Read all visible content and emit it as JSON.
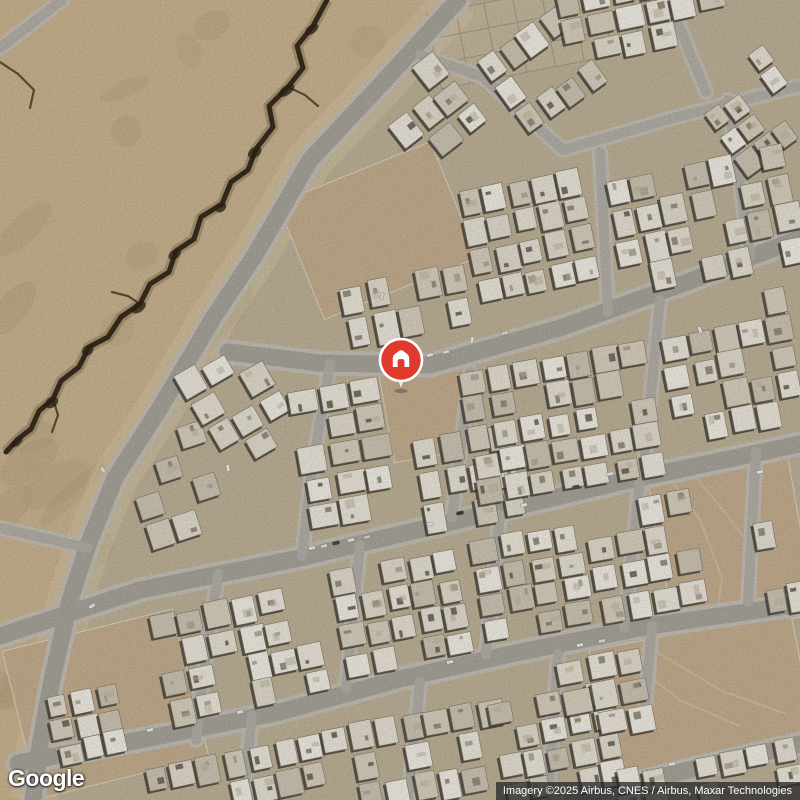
{
  "page": {
    "width": 800,
    "height": 800,
    "app": "google-maps-satellite-view"
  },
  "google_logo": {
    "text": "Google"
  },
  "attribution": {
    "text": "Imagery ©2025 Airbus, CNES / Airbus, Maxar Technologies"
  },
  "marker": {
    "type": "saved-home-place-pin",
    "x": 401,
    "y": 360,
    "radius": 21,
    "tip_y": 389.5,
    "color": "#df3a2c",
    "ring_color": "#ffffff",
    "glyph": "house",
    "glyph_color": "#ffffff",
    "stem_color": "#eceae4"
  },
  "map": {
    "seed": 20250731,
    "colors": {
      "ground": "#c3b69b",
      "desert": "#cfb995",
      "desert_shade": "#b29a76",
      "shoulder": "#dbcbab",
      "road_main": "#aca89f",
      "road_minor": "#b8b4ac",
      "road_casing": "#c9c4ba",
      "crack_dark": "#2f2517",
      "crack_mid": "#5d4527",
      "lot": "#cab293",
      "lot_line": "#e4dcc8",
      "building_shadow": "#3a362f",
      "wall_line": "#857d6c",
      "building_palette": [
        "#f1ece1",
        "#e7e1d3",
        "#ddd5c4",
        "#f6f3ea",
        "#d2cab8",
        "#ece6d9"
      ],
      "clutter_palette": [
        "#b3ab9a",
        "#948c7a",
        "#6f685a"
      ],
      "grid_line": "#a19a8c",
      "track_line": "#d8cdb4"
    },
    "desert_polygon": [
      [
        0,
        0
      ],
      [
        458,
        0
      ],
      [
        385,
        80
      ],
      [
        310,
        160
      ],
      [
        255,
        255
      ],
      [
        215,
        315
      ],
      [
        160,
        408
      ],
      [
        115,
        478
      ],
      [
        88,
        545
      ],
      [
        70,
        600
      ],
      [
        52,
        680
      ],
      [
        40,
        745
      ],
      [
        33,
        800
      ],
      [
        0,
        800
      ]
    ],
    "crack_main": [
      [
        327,
        0
      ],
      [
        313,
        26
      ],
      [
        297,
        46
      ],
      [
        303,
        68
      ],
      [
        288,
        87
      ],
      [
        269,
        106
      ],
      [
        273,
        127
      ],
      [
        256,
        149
      ],
      [
        248,
        170
      ],
      [
        231,
        182
      ],
      [
        222,
        204
      ],
      [
        201,
        217
      ],
      [
        194,
        239
      ],
      [
        176,
        251
      ],
      [
        169,
        272
      ],
      [
        150,
        284
      ],
      [
        140,
        304
      ],
      [
        121,
        317
      ],
      [
        108,
        337
      ],
      [
        89,
        347
      ],
      [
        79,
        367
      ],
      [
        61,
        381
      ],
      [
        53,
        399
      ],
      [
        39,
        411
      ],
      [
        31,
        429
      ],
      [
        18,
        439
      ],
      [
        6,
        452
      ]
    ],
    "crack_branches": [
      [
        [
          288,
          87
        ],
        [
          305,
          95
        ],
        [
          318,
          106
        ]
      ],
      [
        [
          140,
          304
        ],
        [
          128,
          296
        ],
        [
          112,
          292
        ]
      ],
      [
        [
          53,
          399
        ],
        [
          58,
          415
        ],
        [
          52,
          432
        ]
      ],
      [
        [
          0,
          62
        ],
        [
          18,
          74
        ],
        [
          34,
          90
        ],
        [
          30,
          108
        ]
      ]
    ],
    "roads_main": [
      [
        [
          458,
          0
        ],
        [
          385,
          80
        ],
        [
          310,
          160
        ],
        [
          255,
          255
        ],
        [
          215,
          315
        ],
        [
          160,
          408
        ],
        [
          115,
          478
        ],
        [
          88,
          545
        ],
        [
          70,
          600
        ],
        [
          52,
          680
        ],
        [
          40,
          745
        ],
        [
          33,
          800
        ]
      ],
      [
        [
          228,
          352
        ],
        [
          320,
          363
        ],
        [
          430,
          365
        ],
        [
          560,
          328
        ],
        [
          690,
          281
        ],
        [
          800,
          238
        ]
      ],
      [
        [
          0,
          636
        ],
        [
          140,
          590
        ],
        [
          300,
          558
        ],
        [
          460,
          520
        ],
        [
          620,
          482
        ],
        [
          800,
          444
        ]
      ],
      [
        [
          18,
          763
        ],
        [
          150,
          738
        ],
        [
          280,
          712
        ],
        [
          400,
          679
        ],
        [
          520,
          652
        ],
        [
          650,
          626
        ],
        [
          800,
          604
        ]
      ],
      [
        [
          572,
          800
        ],
        [
          680,
          772
        ],
        [
          800,
          744
        ]
      ]
    ],
    "roads_minor": [
      [
        [
          600,
          152
        ],
        [
          608,
          312
        ]
      ],
      [
        [
          420,
          55
        ],
        [
          483,
          77
        ],
        [
          563,
          150
        ]
      ],
      [
        [
          563,
          150
        ],
        [
          680,
          116
        ],
        [
          800,
          86
        ]
      ],
      [
        [
          670,
          4
        ],
        [
          706,
          92
        ]
      ],
      [
        [
          750,
          256
        ],
        [
          728,
          100
        ]
      ],
      [
        [
          330,
          364
        ],
        [
          312,
          470
        ],
        [
          302,
          556
        ]
      ],
      [
        [
          470,
          372
        ],
        [
          452,
          518
        ]
      ],
      [
        [
          660,
          300
        ],
        [
          643,
          476
        ]
      ],
      [
        [
          218,
          574
        ],
        [
          200,
          700
        ],
        [
          196,
          740
        ]
      ],
      [
        [
          360,
          545
        ],
        [
          346,
          688
        ]
      ],
      [
        [
          500,
          515
        ],
        [
          486,
          655
        ]
      ],
      [
        [
          640,
          480
        ],
        [
          624,
          628
        ]
      ],
      [
        [
          756,
          452
        ],
        [
          748,
          602
        ]
      ],
      [
        [
          420,
          682
        ],
        [
          408,
          800
        ]
      ],
      [
        [
          558,
          654
        ],
        [
          548,
          796
        ]
      ],
      [
        [
          652,
          626
        ],
        [
          644,
          718
        ]
      ],
      [
        [
          252,
          716
        ],
        [
          243,
          800
        ]
      ],
      [
        [
          0,
          48
        ],
        [
          62,
          0
        ]
      ],
      [
        [
          88,
          548
        ],
        [
          0,
          528
        ]
      ]
    ],
    "plot_grid": {
      "x": 432,
      "y": -6,
      "w": 204,
      "h": 76,
      "rot": -11,
      "cols": 7,
      "rows": 3
    },
    "lots": [
      {
        "x": 386,
        "y": 366,
        "w": 86,
        "h": 90,
        "rot": -10
      },
      {
        "x": 660,
        "y": 460,
        "w": 142,
        "h": 168,
        "rot": -10
      },
      {
        "x": 18,
        "y": 628,
        "w": 175,
        "h": 152,
        "rot": -14
      },
      {
        "x": 295,
        "y": 168,
        "w": 165,
        "h": 125,
        "rot": -22
      },
      {
        "x": 600,
        "y": 630,
        "w": 205,
        "h": 132,
        "rot": -11
      }
    ],
    "lot_tracks": [
      [
        [
          666,
          472
        ],
        [
          700,
          520
        ],
        [
          722,
          578
        ],
        [
          716,
          622
        ]
      ],
      [
        [
          688,
          468
        ],
        [
          728,
          516
        ],
        [
          758,
          556
        ]
      ],
      [
        [
          628,
          660
        ],
        [
          680,
          700
        ],
        [
          740,
          726
        ]
      ],
      [
        [
          650,
          648
        ],
        [
          720,
          690
        ],
        [
          786,
          714
        ]
      ]
    ],
    "blocks": [
      {
        "x": 385,
        "y": 68,
        "w": 88,
        "h": 92,
        "rot": -38,
        "d": 0.7
      },
      {
        "x": 492,
        "y": 24,
        "w": 100,
        "h": 95,
        "rot": -36,
        "d": 0.72
      },
      {
        "x": 558,
        "y": -26,
        "w": 170,
        "h": 80,
        "rot": -12,
        "d": 0.7
      },
      {
        "x": 706,
        "y": 58,
        "w": 96,
        "h": 102,
        "rot": -36,
        "d": 0.62
      },
      {
        "x": 612,
        "y": 158,
        "w": 188,
        "h": 124,
        "rot": -12,
        "d": 0.8
      },
      {
        "x": 466,
        "y": 176,
        "w": 126,
        "h": 120,
        "rot": -12,
        "d": 0.8
      },
      {
        "x": 344,
        "y": 270,
        "w": 126,
        "h": 72,
        "rot": -11,
        "d": 0.8
      },
      {
        "x": 130,
        "y": 428,
        "w": 92,
        "h": 112,
        "rot": -18,
        "d": 0.8
      },
      {
        "x": 198,
        "y": 348,
        "w": 86,
        "h": 118,
        "rot": -30,
        "d": 0.75
      },
      {
        "x": 298,
        "y": 380,
        "w": 94,
        "h": 146,
        "rot": -10,
        "d": 0.85
      },
      {
        "x": 418,
        "y": 430,
        "w": 102,
        "h": 98,
        "rot": -10,
        "d": 0.8
      },
      {
        "x": 466,
        "y": 354,
        "w": 192,
        "h": 138,
        "rot": -10,
        "d": 0.85
      },
      {
        "x": 664,
        "y": 294,
        "w": 136,
        "h": 142,
        "rot": -11,
        "d": 0.8
      },
      {
        "x": 158,
        "y": 596,
        "w": 166,
        "h": 116,
        "rot": -12,
        "d": 0.8
      },
      {
        "x": 336,
        "y": 558,
        "w": 132,
        "h": 110,
        "rot": -11,
        "d": 0.8
      },
      {
        "x": 476,
        "y": 530,
        "w": 112,
        "h": 106,
        "rot": -10,
        "d": 0.8
      },
      {
        "x": 590,
        "y": 496,
        "w": 112,
        "h": 120,
        "rot": -10,
        "d": 0.75
      },
      {
        "x": 52,
        "y": 686,
        "w": 72,
        "h": 76,
        "rot": -12,
        "d": 0.9
      },
      {
        "x": 760,
        "y": 518,
        "w": 46,
        "h": 96,
        "rot": -10,
        "d": 0.7
      },
      {
        "x": 146,
        "y": 746,
        "w": 182,
        "h": 62,
        "rot": -12,
        "d": 0.8
      },
      {
        "x": 328,
        "y": 710,
        "w": 182,
        "h": 94,
        "rot": -11,
        "d": 0.85
      },
      {
        "x": 495,
        "y": 688,
        "w": 125,
        "h": 110,
        "rot": -11,
        "d": 0.85
      },
      {
        "x": 560,
        "y": 650,
        "w": 92,
        "h": 88,
        "rot": -11,
        "d": 0.85
      },
      {
        "x": 590,
        "y": 756,
        "w": 212,
        "h": 52,
        "rot": -11,
        "d": 0.85
      }
    ],
    "cars": [
      [
        312,
        548,
        -12,
        "#f4f4f2"
      ],
      [
        324,
        546,
        -12,
        "#e9e9e5"
      ],
      [
        336,
        543,
        -12,
        "#4a4a48"
      ],
      [
        351,
        540,
        -12,
        "#f4f4f2"
      ],
      [
        367,
        537,
        -12,
        "#dddad4"
      ],
      [
        430,
        355,
        -12,
        "#f6f6f4"
      ],
      [
        446,
        352,
        -12,
        "#ededea"
      ],
      [
        472,
        340,
        -80,
        "#f2f2ef"
      ],
      [
        505,
        333,
        -10,
        "#e4e4e0"
      ],
      [
        430,
        524,
        -12,
        "#f0f0ee"
      ],
      [
        460,
        513,
        -12,
        "#3f3f3d"
      ],
      [
        524,
        505,
        -12,
        "#f4f4f1"
      ],
      [
        610,
        474,
        -10,
        "#f1f1ee"
      ],
      [
        576,
        487,
        -10,
        "#54544f"
      ],
      [
        700,
        330,
        70,
        "#f5f5f3"
      ],
      [
        760,
        472,
        -10,
        "#f7f7f5"
      ],
      [
        580,
        645,
        -11,
        "#f3f3f0"
      ],
      [
        602,
        641,
        -11,
        "#e7e7e3"
      ],
      [
        450,
        662,
        -11,
        "#f5f5f2"
      ],
      [
        240,
        712,
        -12,
        "#eeeeea"
      ],
      [
        150,
        730,
        -12,
        "#f2f2ef"
      ],
      [
        672,
        764,
        -11,
        "#f3f3f1"
      ],
      [
        92,
        606,
        -30,
        "#f3f3f0"
      ],
      [
        103,
        470,
        55,
        "#ededeb"
      ],
      [
        228,
        468,
        80,
        "#f6f6f3"
      ],
      [
        382,
        296,
        -80,
        "#ebebe8"
      ]
    ]
  }
}
